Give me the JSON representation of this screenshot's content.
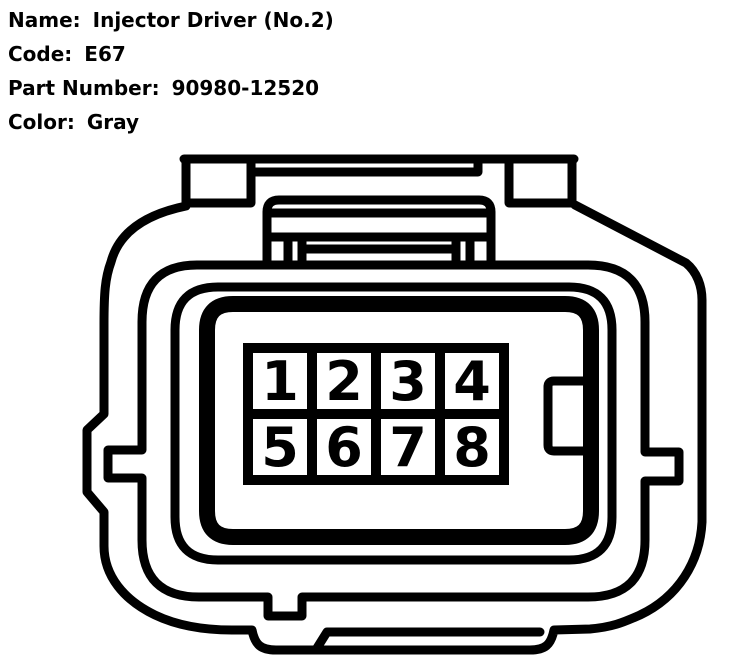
{
  "header": {
    "fields": [
      {
        "label": "Name:",
        "value": "Injector Driver (No.2)"
      },
      {
        "label": "Code:",
        "value": "E67"
      },
      {
        "label": "Part Number:",
        "value": "90980-12520"
      },
      {
        "label": "Color:",
        "value": "Gray"
      }
    ]
  },
  "connector": {
    "type": "8-pin female connector, front view",
    "rows": 2,
    "cols": 4,
    "pins": [
      "1",
      "2",
      "3",
      "4",
      "5",
      "6",
      "7",
      "8"
    ],
    "line_color": "#000000",
    "background_color": "#ffffff"
  }
}
